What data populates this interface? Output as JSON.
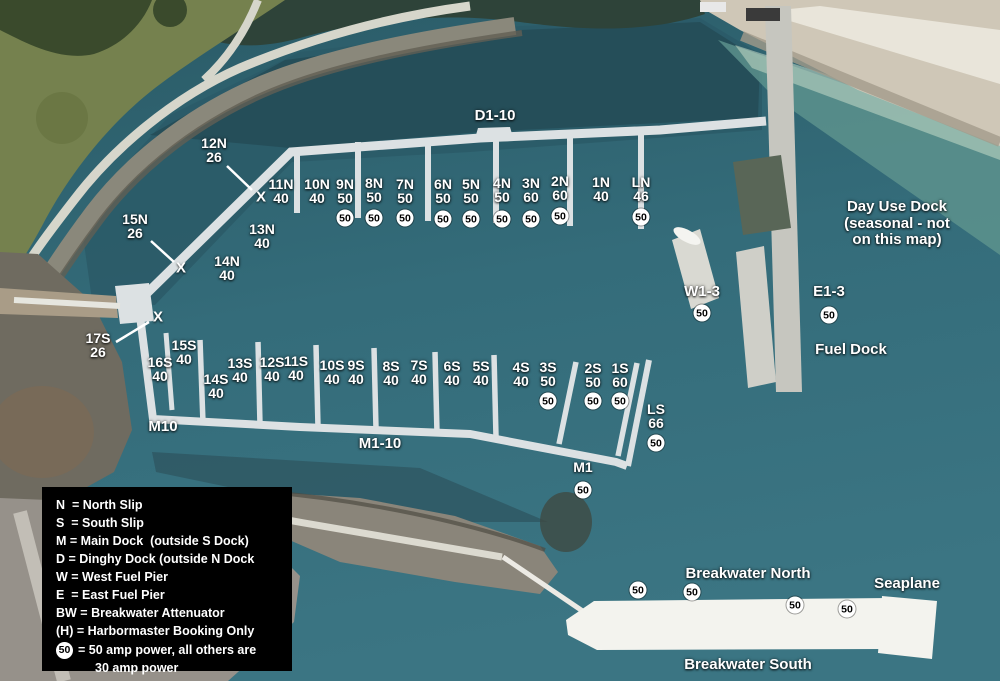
{
  "map": {
    "badge_text": "50",
    "x_mark": "X",
    "colors": {
      "water_top": "#2a5a66",
      "water_mid": "#346c7a",
      "water_bottom": "#3b7583",
      "dock": "#dce1e3",
      "breakwater": "#f3f3ee",
      "label_text": "#ffffff",
      "badge_bg": "#ffffff",
      "badge_text": "#000000",
      "legend_bg": "#000000",
      "grass": "#75814e",
      "beach": "#cfc7b7"
    },
    "slips": [
      {
        "name": "12N",
        "size": "26",
        "x": 214,
        "y": 136
      },
      {
        "name": "15N",
        "size": "26",
        "x": 135,
        "y": 212
      },
      {
        "name": "13N",
        "size": "40",
        "x": 262,
        "y": 222
      },
      {
        "name": "14N",
        "size": "40",
        "x": 227,
        "y": 254
      },
      {
        "name": "11N",
        "size": "40",
        "x": 281,
        "y": 177
      },
      {
        "name": "10N",
        "size": "40",
        "x": 317,
        "y": 177
      },
      {
        "name": "9N",
        "size": "50",
        "x": 345,
        "y": 177,
        "amp50": true,
        "by": 218
      },
      {
        "name": "8N",
        "size": "50",
        "x": 374,
        "y": 176,
        "amp50": true,
        "by": 218
      },
      {
        "name": "7N",
        "size": "50",
        "x": 405,
        "y": 177,
        "amp50": true,
        "by": 218
      },
      {
        "name": "6N",
        "size": "50",
        "x": 443,
        "y": 177,
        "amp50": true,
        "by": 219
      },
      {
        "name": "5N",
        "size": "50",
        "x": 471,
        "y": 177,
        "amp50": true,
        "by": 219
      },
      {
        "name": "4N",
        "size": "50",
        "x": 502,
        "y": 176,
        "amp50": true,
        "by": 219
      },
      {
        "name": "3N",
        "size": "60",
        "x": 531,
        "y": 176,
        "amp50": true,
        "by": 219
      },
      {
        "name": "2N",
        "size": "60",
        "x": 560,
        "y": 174,
        "amp50": true,
        "by": 216
      },
      {
        "name": "1N",
        "size": "40",
        "x": 601,
        "y": 175
      },
      {
        "name": "LN",
        "size": "46",
        "x": 641,
        "y": 175,
        "amp50": true,
        "by": 217
      },
      {
        "name": "17S",
        "size": "26",
        "x": 98,
        "y": 331
      },
      {
        "name": "16S",
        "size": "40",
        "x": 160,
        "y": 355
      },
      {
        "name": "15S",
        "size": "40",
        "x": 184,
        "y": 338
      },
      {
        "name": "14S",
        "size": "40",
        "x": 216,
        "y": 372
      },
      {
        "name": "13S",
        "size": "40",
        "x": 240,
        "y": 356
      },
      {
        "name": "12S",
        "size": "40",
        "x": 272,
        "y": 355
      },
      {
        "name": "11S",
        "size": "40",
        "x": 296,
        "y": 354
      },
      {
        "name": "10S",
        "size": "40",
        "x": 332,
        "y": 358
      },
      {
        "name": "9S",
        "size": "40",
        "x": 356,
        "y": 358
      },
      {
        "name": "8S",
        "size": "40",
        "x": 391,
        "y": 359
      },
      {
        "name": "7S",
        "size": "40",
        "x": 419,
        "y": 358
      },
      {
        "name": "6S",
        "size": "40",
        "x": 452,
        "y": 359
      },
      {
        "name": "5S",
        "size": "40",
        "x": 481,
        "y": 359
      },
      {
        "name": "4S",
        "size": "40",
        "x": 521,
        "y": 360
      },
      {
        "name": "3S",
        "size": "50",
        "x": 548,
        "y": 360,
        "amp50": true,
        "by": 401
      },
      {
        "name": "2S",
        "size": "50",
        "x": 593,
        "y": 361,
        "amp50": true,
        "by": 401
      },
      {
        "name": "1S",
        "size": "60",
        "x": 620,
        "y": 361,
        "amp50": true,
        "by": 401
      },
      {
        "name": "LS",
        "size": "66",
        "x": 656,
        "y": 402,
        "amp50": true,
        "by": 443
      },
      {
        "name": "M1",
        "size": "",
        "x": 583,
        "y": 460,
        "amp50": true,
        "by": 490
      }
    ],
    "region_labels": [
      {
        "id": "dinghy-dock-range",
        "text": "D1-10",
        "x": 495,
        "y": 108
      },
      {
        "id": "main-dock-m10",
        "text": "M10",
        "x": 163,
        "y": 419
      },
      {
        "id": "main-dock-range",
        "text": "M1-10",
        "x": 380,
        "y": 436
      },
      {
        "id": "west-fuel-pier",
        "text": "W1-3",
        "x": 702,
        "y": 284,
        "amp50": true,
        "by": 313
      },
      {
        "id": "east-fuel-pier",
        "text": "E1-3",
        "x": 829,
        "y": 284,
        "amp50": true,
        "by": 315
      },
      {
        "id": "fuel-dock",
        "text": "Fuel Dock",
        "x": 851,
        "y": 342
      },
      {
        "id": "breakwater-north",
        "text": "Breakwater North",
        "x": 748,
        "y": 566
      },
      {
        "id": "seaplane",
        "text": "Seaplane",
        "x": 907,
        "y": 576
      },
      {
        "id": "breakwater-south",
        "text": "Breakwater South",
        "x": 748,
        "y": 657
      }
    ],
    "day_use_note": {
      "lines": [
        "Day Use Dock",
        "(seasonal - not",
        "on this map)"
      ],
      "x": 897,
      "y": 199
    },
    "x_marks": [
      {
        "x": 261,
        "y": 197
      },
      {
        "x": 181,
        "y": 268
      },
      {
        "x": 158,
        "y": 317
      }
    ],
    "leader_lines": [
      {
        "x1": 227,
        "y1": 166,
        "x2": 252,
        "y2": 190
      },
      {
        "x1": 151,
        "y1": 241,
        "x2": 174,
        "y2": 262
      },
      {
        "x1": 116,
        "y1": 342,
        "x2": 149,
        "y2": 322
      }
    ],
    "standalone_badges": [
      {
        "id": "breakwater-badge-1",
        "x": 638,
        "y": 590
      },
      {
        "id": "breakwater-badge-2",
        "x": 692,
        "y": 592
      },
      {
        "id": "breakwater-badge-3",
        "x": 795,
        "y": 605
      },
      {
        "id": "breakwater-badge-4",
        "x": 847,
        "y": 609
      }
    ]
  },
  "legend": {
    "rows": [
      "N  = North Slip",
      "S  = South Slip",
      "M = Main Dock  (outside S Dock)",
      "D = Dinghy Dock (outside N Dock",
      "W = West Fuel Pier",
      "E  = East Fuel Pier",
      "BW = Breakwater Attenuator",
      "(H) = Harbormaster Booking Only"
    ],
    "amp_row": {
      "badge": "50",
      "text": "= 50 amp power, all others are",
      "text2": "30 amp power"
    }
  }
}
